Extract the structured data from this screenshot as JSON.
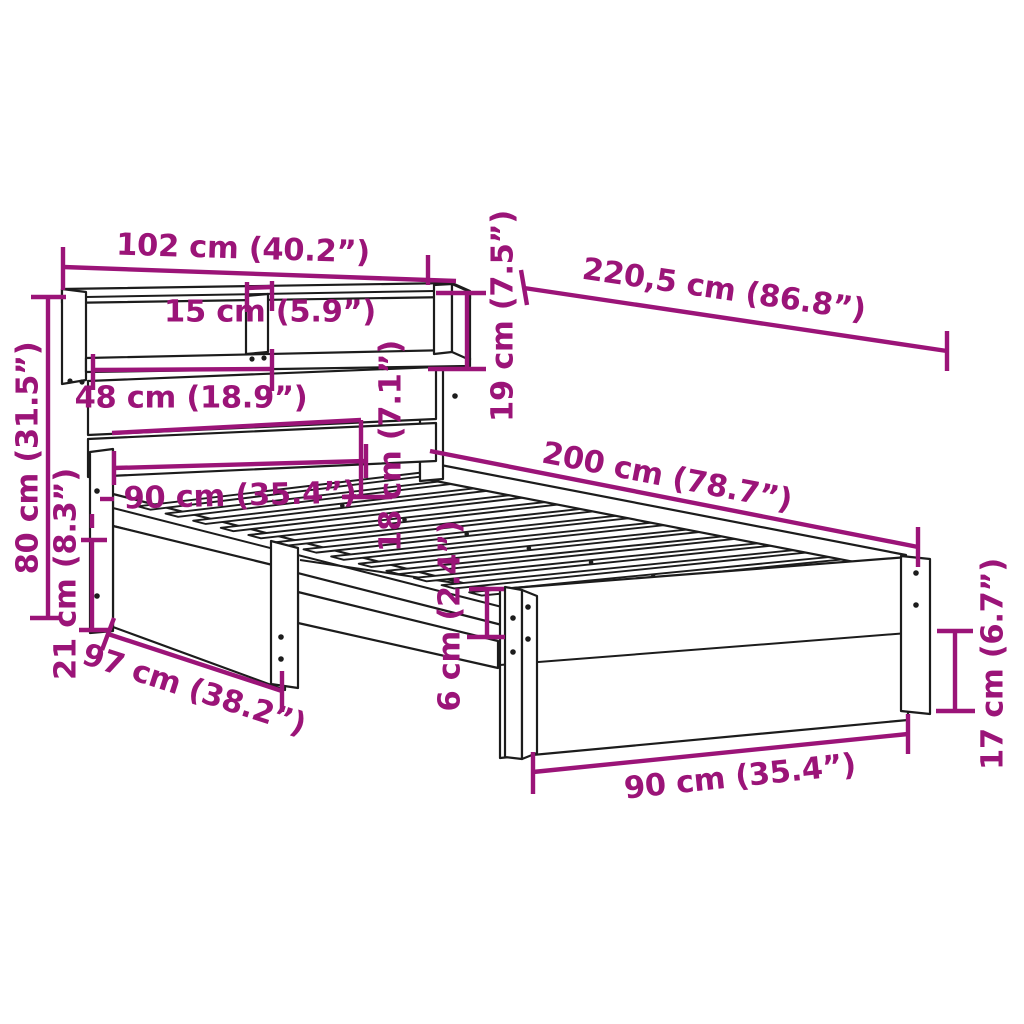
{
  "diagram": {
    "accent_color": "#9b1478",
    "line_color": "#1c1c1c",
    "background_color": "#ffffff",
    "dimensions": {
      "headboard_width": "102 cm (40.2”)",
      "total_length": "220,5 cm (86.8”)",
      "shelf_height": "19 cm (7.5”)",
      "shelf_compartment": "15 cm (5.9”)",
      "shelf_opening_width": "48 cm (18.9”)",
      "headboard_height": "80 cm (31.5”)",
      "underbed_clearance": "21 cm (8.3”)",
      "bed_width_head": "90 cm (35.4”)",
      "headboard_above_bed": "18 cm (7.1”)",
      "bed_length": "200 cm (78.7”)",
      "side_rail_height": "6 cm (2.4”)",
      "frame_outer_width": "97 cm (38.2”)",
      "bed_width_foot": "90 cm (35.4”)",
      "leg_height": "17 cm (6.7”)"
    }
  }
}
